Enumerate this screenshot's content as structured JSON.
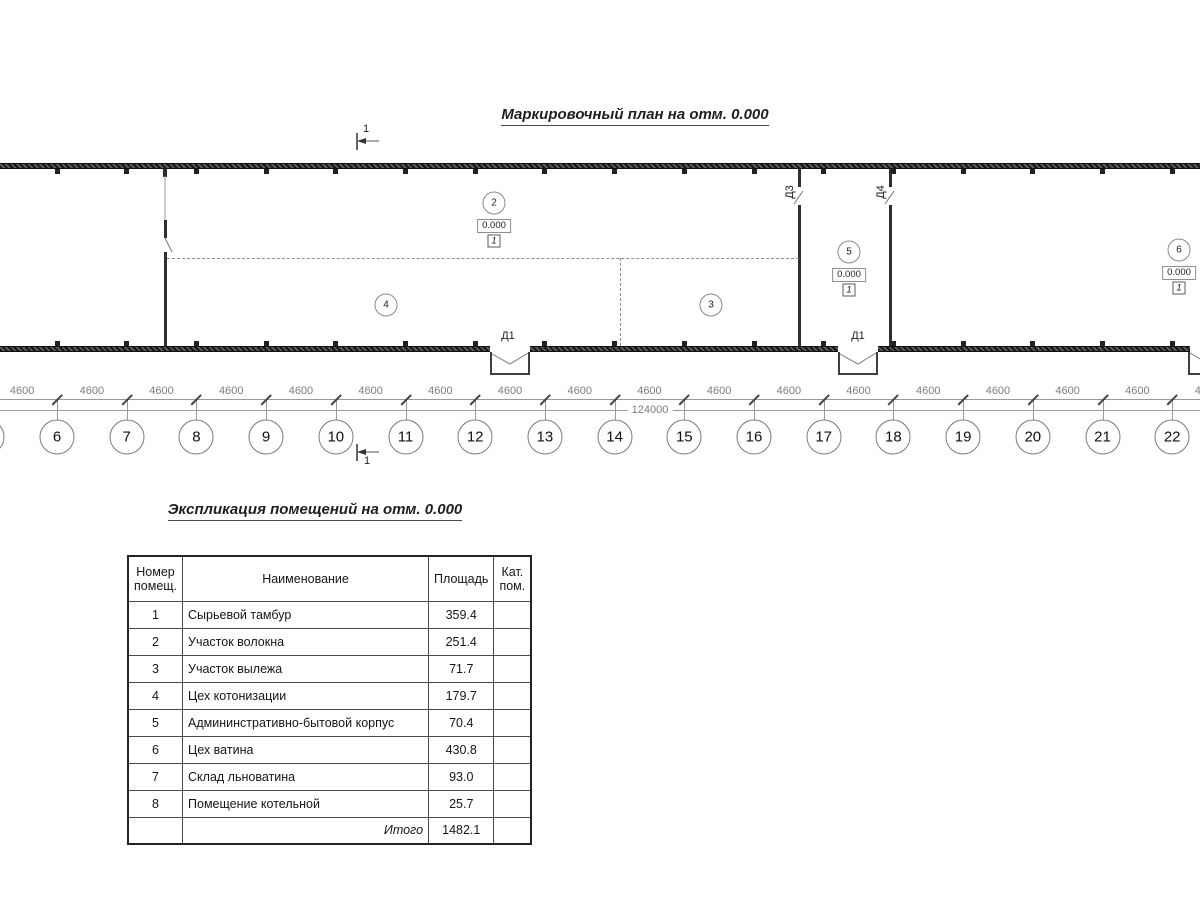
{
  "plan": {
    "title": "Маркировочный план на отм. 0.000",
    "section_label": "1",
    "grid_bubbles": [
      "6",
      "7",
      "8",
      "9",
      "10",
      "11",
      "12",
      "13",
      "14",
      "15",
      "16",
      "17",
      "18",
      "19",
      "20",
      "21",
      "22"
    ],
    "dim_segment": "4600",
    "dim_overall": "124000",
    "room_markers": [
      {
        "number": "2",
        "x": 494,
        "y": 203,
        "elevation": "0.000",
        "category": "1"
      },
      {
        "number": "4",
        "x": 386,
        "y": 305
      },
      {
        "number": "3",
        "x": 711,
        "y": 305
      },
      {
        "number": "5",
        "x": 849,
        "y": 252,
        "elevation": "0.000",
        "category": "1"
      },
      {
        "number": "6",
        "x": 1179,
        "y": 250,
        "elevation": "0.000",
        "category": "1"
      }
    ],
    "door_labels": [
      {
        "text": "Д1",
        "x": 508,
        "y": 336,
        "rotated": false
      },
      {
        "text": "Д1",
        "x": 858,
        "y": 336,
        "rotated": false
      },
      {
        "text": "Д3",
        "x": 790,
        "y": 192,
        "rotated": true
      },
      {
        "text": "Д4",
        "x": 881,
        "y": 192,
        "rotated": true
      }
    ]
  },
  "schedule": {
    "title": "Экспликация помещений на отм. 0.000",
    "headers": [
      "Номер\nпомещ.",
      "Наименование",
      "Площадь",
      "Кат.\nпом."
    ],
    "rows": [
      {
        "num": "1",
        "name": "Сырьевой тамбур",
        "area": "359.4",
        "cat": ""
      },
      {
        "num": "2",
        "name": "Участок волокна",
        "area": "251.4",
        "cat": ""
      },
      {
        "num": "3",
        "name": "Участок вылежа",
        "area": "71.7",
        "cat": ""
      },
      {
        "num": "4",
        "name": "Цех котонизации",
        "area": "179.7",
        "cat": ""
      },
      {
        "num": "5",
        "name": "Админинстративно-бытовой корпус",
        "area": "70.4",
        "cat": ""
      },
      {
        "num": "6",
        "name": "Цех ватина",
        "area": "430.8",
        "cat": ""
      },
      {
        "num": "7",
        "name": "Склад льноватина",
        "area": "93.0",
        "cat": ""
      },
      {
        "num": "8",
        "name": "Помещение котельной",
        "area": "25.7",
        "cat": ""
      }
    ],
    "total_label": "Итого",
    "total_area": "1482.1"
  }
}
